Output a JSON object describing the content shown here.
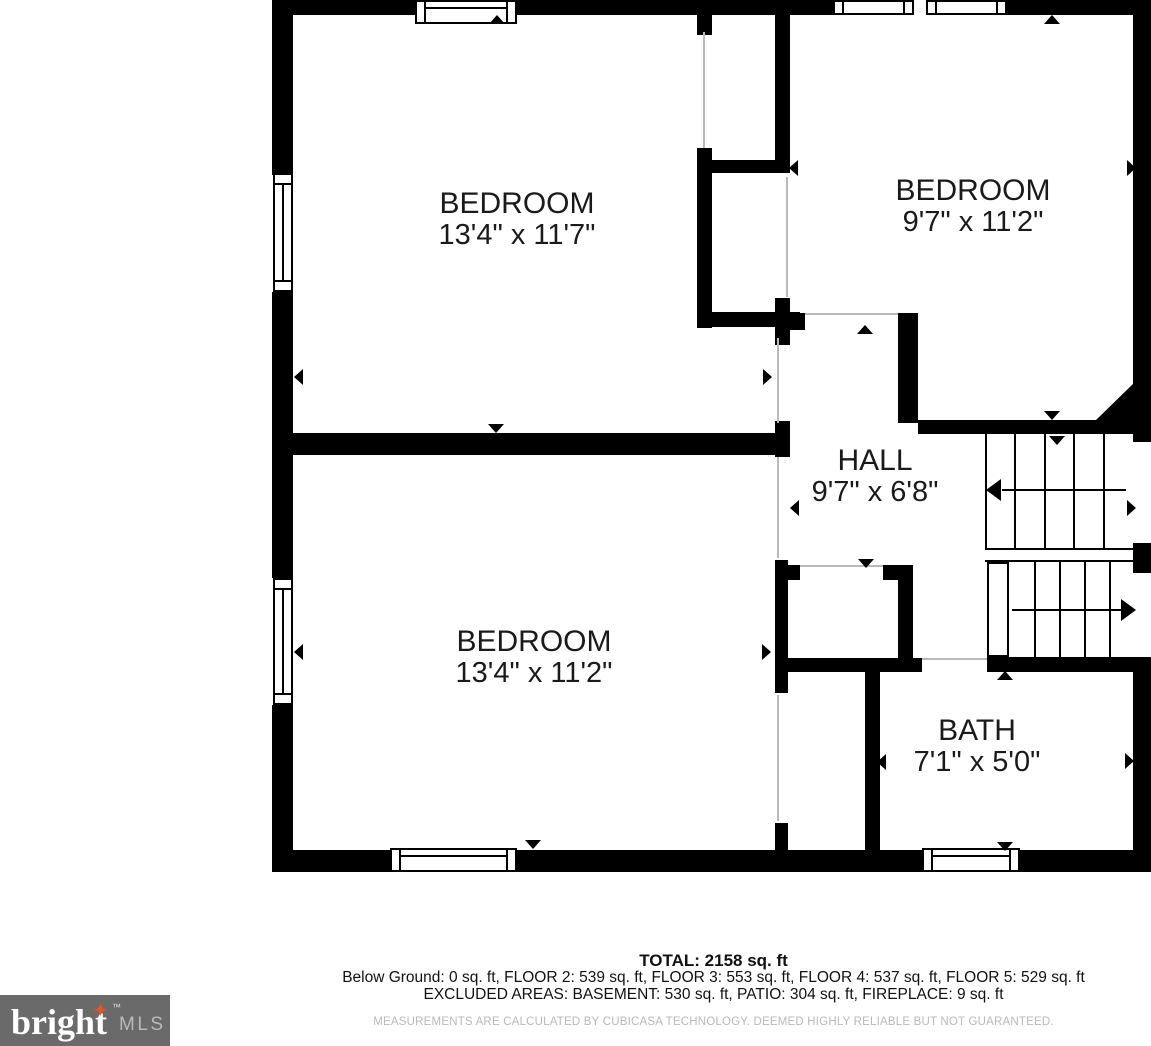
{
  "plan": {
    "rooms": [
      {
        "id": "bedroom-top-left",
        "name": "BEDROOM",
        "dims": "13'4\" x 11'7\""
      },
      {
        "id": "bedroom-top-right",
        "name": "BEDROOM",
        "dims": "9'7\" x 11'2\""
      },
      {
        "id": "hall",
        "name": "HALL",
        "dims": "9'7\" x 6'8\""
      },
      {
        "id": "bedroom-bottom",
        "name": "BEDROOM",
        "dims": "13'4\" x 11'2\""
      },
      {
        "id": "bath",
        "name": "BATH",
        "dims": "7'1\" x 5'0\""
      }
    ],
    "features": [
      "stairs-up",
      "stairs-down",
      "closets",
      "windows"
    ]
  },
  "summary": {
    "total": "TOTAL: 2158 sq. ft",
    "floors": "Below Ground: 0 sq. ft, FLOOR 2: 539 sq. ft, FLOOR 3: 553 sq. ft, FLOOR 4: 537 sq. ft, FLOOR 5: 529 sq. ft",
    "excluded": "EXCLUDED AREAS: BASEMENT: 530 sq. ft, PATIO: 304 sq. ft, FIREPLACE: 9 sq. ft",
    "disclaimer": "MEASUREMENTS ARE CALCULATED BY CUBICASA TECHNOLOGY. DEEMED HIGHLY RELIABLE BUT NOT GUARANTEED."
  },
  "logo": {
    "brand": "bright",
    "suffix": "MLS",
    "tm": "™",
    "star": "✦"
  },
  "colors": {
    "wall": "#000000",
    "background": "#ffffff",
    "logo_bg": "#6a6a6a",
    "logo_brand_text": "#ffffff",
    "logo_suffix_text": "#b8b9bb",
    "star": "#e2552b",
    "disclaimer_text": "#b9b9b9"
  }
}
